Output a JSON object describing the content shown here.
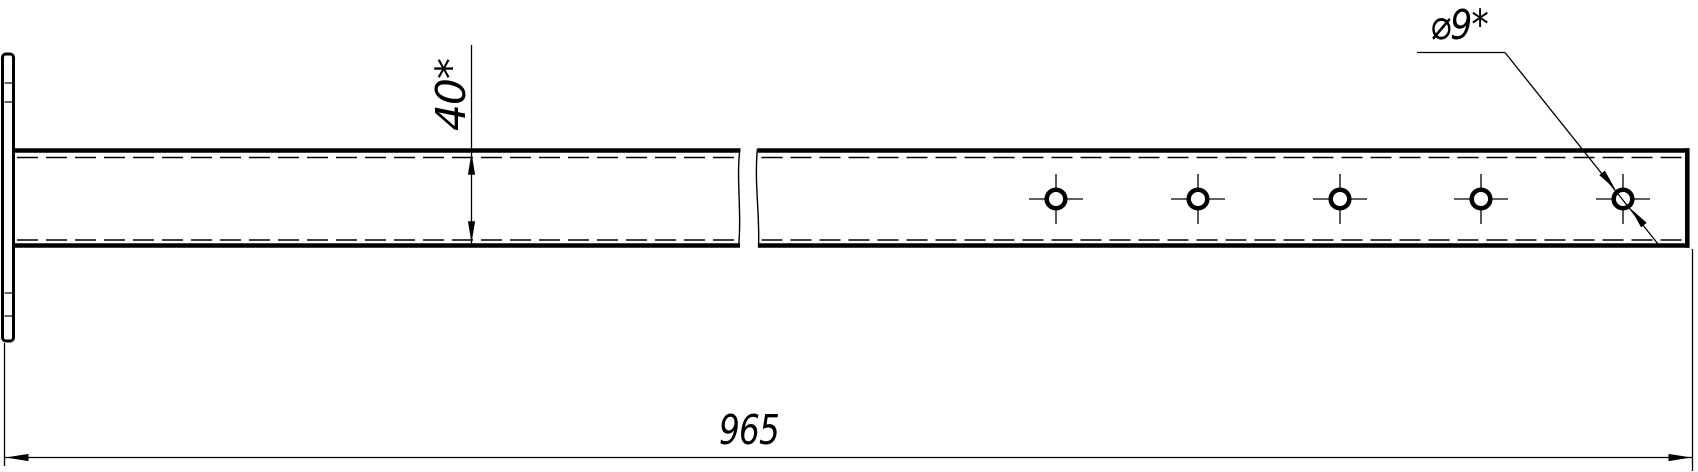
{
  "drawing": {
    "title": "flat bar with holes and end flange",
    "colors": {
      "ink": "#000000",
      "paper": "#ffffff"
    },
    "labels": {
      "width_dim": "40*",
      "hole_dim": "⌀9*",
      "length_dim": "965"
    },
    "geometry": {
      "canvas": {
        "w": 1698,
        "h": 472
      },
      "plate": {
        "x": 2.5,
        "y": 54,
        "w": 11,
        "h": 287,
        "rx": 3.5,
        "stroke": 3,
        "ticks": [
          83,
          102,
          293,
          316
        ]
      },
      "bar": {
        "top_y": 150.5,
        "bottom_y": 245.5,
        "edge_w": 4.6,
        "dash_top_y": 157.5,
        "dash_bottom_y": 240,
        "seg_a": {
          "x1": 13.5,
          "x2": 740
        },
        "seg_b": {
          "x1": 758,
          "x2": 1689.5
        },
        "right_cap_x": 1687.3,
        "cap_y1": 148.2,
        "cap_y2": 247.8,
        "dash_pattern": "21 8",
        "thin": 1.4
      },
      "break_lines": [
        "M740,148.5 C736,178 742,212 738.5,247.5",
        "M757.5,148.5 C754,182 760,214 758.5,247.5"
      ],
      "holes": {
        "cx": [
          1056,
          1198,
          1340,
          1481,
          1623
        ],
        "cy": 199,
        "r": 9.3,
        "ring_w": 4.5,
        "ch_h": 27,
        "ch_v": 25
      },
      "dim40": {
        "x": 471.5,
        "y_top": 45,
        "tip_up_y": 152.8,
        "tip_down_y": 243.2,
        "arrow_len": 22,
        "arrow_hw": 3.6
      },
      "dim965": {
        "y": 457.5,
        "x1": 4.5,
        "x2": 1692.5,
        "ext_left": {
          "x": 4.5,
          "y1": 343,
          "y2": 466
        },
        "ext_right": {
          "x": 1692.5,
          "y1": 249,
          "y2": 471
        },
        "arrow_len": 23,
        "arrow_hw": 3.6
      },
      "leader": {
        "shoulder_x1": 1417,
        "shoulder_x2": 1505,
        "shoulder_y": 52.5,
        "end_x": 1658,
        "end_y": 244,
        "hole_index": 4,
        "gap_r": 12.5,
        "arrow_len": 21,
        "arrow_hw": 3.6
      }
    }
  }
}
